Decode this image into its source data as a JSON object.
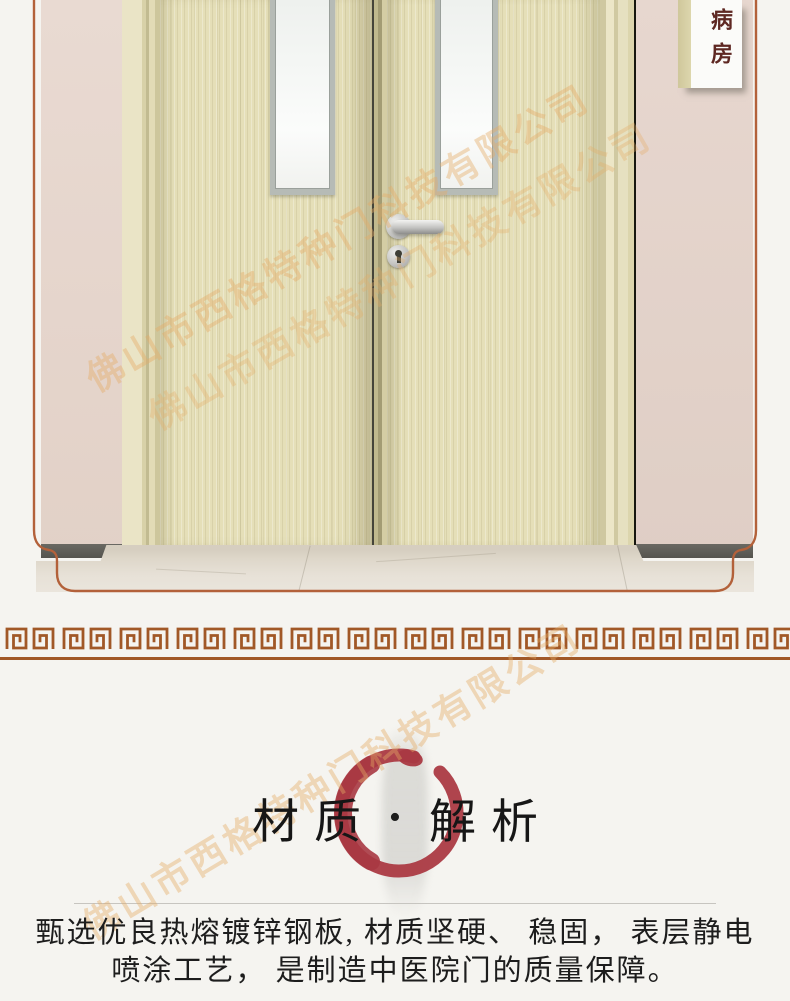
{
  "photo": {
    "ward_sign": "病房"
  },
  "watermark": {
    "text": "佛山市西格特种门科技有限公司"
  },
  "section_title": {
    "left": "材质",
    "separator": "•",
    "right": "解析"
  },
  "paragraph": {
    "line1": "甄选优良热熔镀锌钢板, 材质坚硬、 稳固， 表层静电",
    "line2": "喷涂工艺， 是制造中医院门的质量保障。"
  },
  "colors": {
    "accent_red": "#ab3a43",
    "meander_brown": "#a15827",
    "frame_line_brown": "#b3613a",
    "sign_text_red": "#5e2722",
    "watermark_tan": "#e4ac66",
    "door_beige": "#e5dfb8",
    "wall_pink": "#e5d5cc",
    "title_black": "#161616"
  }
}
